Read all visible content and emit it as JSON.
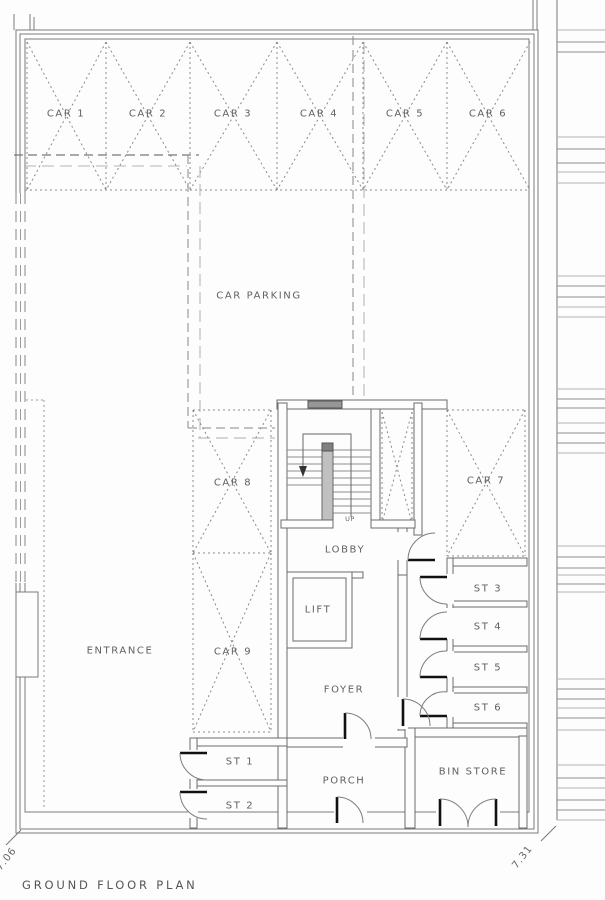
{
  "drawing": {
    "title": "GROUND FLOOR PLAN",
    "dimensions": {
      "left": "7.06",
      "right": "7.31"
    }
  },
  "parking": {
    "area_label": "CAR PARKING",
    "bays": [
      {
        "label": "CAR 1"
      },
      {
        "label": "CAR 2"
      },
      {
        "label": "CAR 3"
      },
      {
        "label": "CAR 4"
      },
      {
        "label": "CAR 5"
      },
      {
        "label": "CAR 6"
      },
      {
        "label": "CAR 7"
      },
      {
        "label": "CAR 8"
      },
      {
        "label": "CAR 9"
      }
    ]
  },
  "rooms": {
    "entrance": "ENTRANCE",
    "lobby": "LOBBY",
    "lift": "LIFT",
    "foyer": "FOYER",
    "porch": "PORCH",
    "bin_store": "BIN STORE"
  },
  "stores": [
    {
      "label": "ST 1"
    },
    {
      "label": "ST 2"
    },
    {
      "label": "ST 3"
    },
    {
      "label": "ST 4"
    },
    {
      "label": "ST 5"
    },
    {
      "label": "ST 6"
    }
  ],
  "stair": {
    "up_label": "UP"
  }
}
